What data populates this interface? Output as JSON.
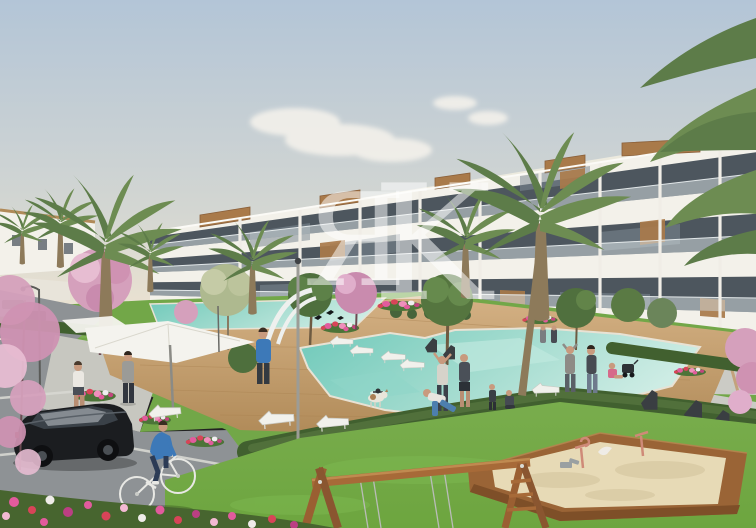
{
  "watermark": {
    "letter_primary": "Я",
    "letter_secondary": "K"
  },
  "colors": {
    "sky_top": "#b3c5d7",
    "sky_horizon": "#e9e1d1",
    "building_white": "#f3f1ea",
    "glass": "#4d565e",
    "wood_accent": "#a97a4a",
    "pool_shallow": "#cdece4",
    "pool_deep": "#6fc9ba",
    "deck_wood": "#c5a071",
    "grass": "#72a748",
    "lawn": "#6da53f",
    "hedge": "#41602f",
    "blossom_pink": "#d5a0bc",
    "palm_green": "#5d7c49",
    "sand": "#e7dab6",
    "sandbox_wood": "#9a6436",
    "asphalt": "#8e9295",
    "path_light": "#cbcbc5",
    "car_black": "#1b1d20",
    "cyclist_blue": "#3d79b8",
    "flower_pink": "#e25b9d",
    "flower_red": "#d84458",
    "umbrella_white": "#f4f3ee",
    "watermark": "rgba(255,255,255,0.52)"
  },
  "scene": {
    "type": "architectural-render",
    "elements": [
      "sky",
      "clouds",
      "apartment-building",
      "penthouse-wood-panels",
      "glass-balconies",
      "palm-trees",
      "blossom-trees",
      "green-trees",
      "swimming-pools",
      "wooden-pool-deck",
      "sun-loungers",
      "white-parasol",
      "lampposts",
      "hedges",
      "flower-beds",
      "lawn",
      "pedestrians",
      "exercise-group",
      "dog",
      "swimmer",
      "cyclist",
      "parked-car",
      "parking-lot",
      "sandbox-playground",
      "spring-riders",
      "swing-frame",
      "path-benches",
      "white-arch-pergola",
      "distant-buildings",
      "birds"
    ]
  }
}
